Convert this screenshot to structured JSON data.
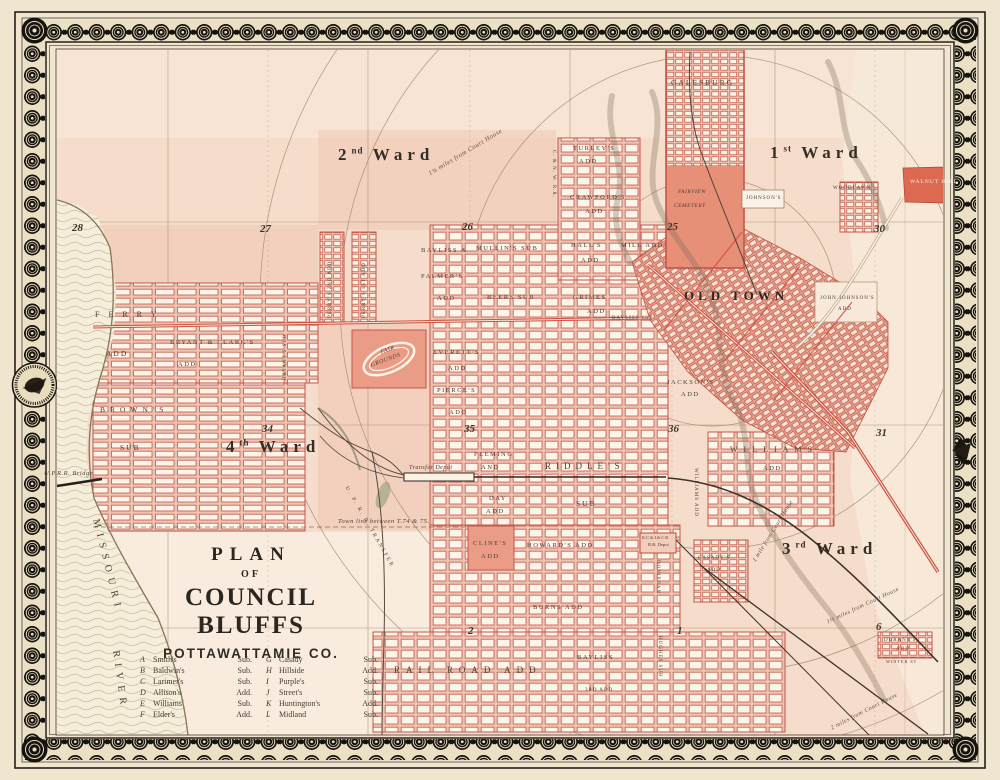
{
  "sheet": {
    "map_name": "Plan of Council Bluffs, Pottawattamie Co."
  },
  "title_block": {
    "plan": "PLAN",
    "of": "OF",
    "city": "COUNCIL BLUFFS",
    "county": "POTTAWATTAMIE CO."
  },
  "wards": {
    "first": {
      "num": "1",
      "sup": "st",
      "word": "Ward"
    },
    "second": {
      "num": "2",
      "sup": "nd",
      "word": "Ward"
    },
    "third": {
      "num": "3",
      "sup": "rd",
      "word": "Ward"
    },
    "fourth": {
      "num": "4",
      "sup": "th",
      "word": "Ward"
    }
  },
  "sections": {
    "s28": "28",
    "s27": "27",
    "s26": "26",
    "s25": "25",
    "s30": "30",
    "s34": "34",
    "s35": "35",
    "s36": "36",
    "s31": "31",
    "s2": "2",
    "s1": "1",
    "s6": "6"
  },
  "river": {
    "name_top": "MISSOURI",
    "name_bottom": "RIVER"
  },
  "legend": {
    "left": [
      {
        "key": "A",
        "name": "Smith's",
        "type": "Sub."
      },
      {
        "key": "B",
        "name": "Baldwin's",
        "type": "Sub."
      },
      {
        "key": "C",
        "name": "Larimer's",
        "type": "Sub."
      },
      {
        "key": "D",
        "name": "Allison's",
        "type": "Add."
      },
      {
        "key": "E",
        "name": "Williams",
        "type": "Sub."
      },
      {
        "key": "F",
        "name": "Elder's",
        "type": "Add."
      }
    ],
    "right": [
      {
        "key": "G",
        "name": "Casady",
        "type": "Sub."
      },
      {
        "key": "H",
        "name": "Hillside",
        "type": "Add."
      },
      {
        "key": "I",
        "name": "Purple's",
        "type": "Sub."
      },
      {
        "key": "J",
        "name": "Street's",
        "type": "Sub."
      },
      {
        "key": "K",
        "name": "Huntington's",
        "type": "Add."
      },
      {
        "key": "L",
        "name": "Midland",
        "type": "Sub."
      }
    ]
  },
  "labels": {
    "ferry": "FERRY",
    "ferry_add": "ADD",
    "browns": "BROWN'S",
    "browns_sub": "SUB",
    "bryant_clark": "BRYANT & CLARK'S",
    "bryant_clark_add": "ADD",
    "bryants_sub": "BRYANT'S SUB",
    "perrys2": "PERRY'S 2ND ADD",
    "perrys1": "PERRY'S 1ST ADD",
    "fair": "FAIR",
    "grounds": "GROUNDS",
    "everetts": "EVERETT'S",
    "everetts_add": "ADD",
    "pierces": "PIERCE'S",
    "pierces_add": "ADD",
    "bayliss_amp": "BAYLISS &",
    "palmers": "PALMER'S",
    "palmers_add": "ADD",
    "mullins": "MULLIN'S SUB",
    "halls": "HALL'S",
    "halls_add": "ADD",
    "beers": "BEERS SUB",
    "grimes": "GRIMES",
    "grimes_add": "ADD",
    "mill_add": "MILL ADD",
    "turleys": "TURLEY'S",
    "turleys_add": "ADD",
    "crawfords": "CRAWFORD'S",
    "crawfords_add": "ADD",
    "galesburg": "GALESBURG",
    "fairview": "FAIRVIEW",
    "cemetery": "CEMETERY",
    "johnsons": "JOHNSON'S",
    "woodlawn": "WOODLAWN",
    "walnut_hill": "WALNUT HILL",
    "john_johnsons": "JOHN JOHNSON'S",
    "john_johnsons_add": "ADD",
    "bayliss_1st": "BAYLISS 1ST",
    "jacksons": "JACKSON'S",
    "jacksons_add": "ADD",
    "old_town": "OLD TOWN",
    "williams": "WILLIAMS",
    "williams_add_word": "ADD",
    "casadys": "CASADY'S",
    "casadys_add": "ADD",
    "fleming": "FLEMING",
    "fleming_and": "AND",
    "riddles": "RIDDLE'S",
    "riddles_sub": "SUB",
    "day": "DAY",
    "day_add": "ADD",
    "clines": "CLINE'S",
    "clines_add": "ADD",
    "howards_add": "HOWARD'S ADD",
    "burns_add": "BURNS ADD",
    "railroad_add": "RAIL ROAD ADD",
    "bayliss_b": "BAYLISS",
    "bayliss_3rd": "3RD ADD",
    "hughes": "HUGHES SUB",
    "doniphan": "DONIPHAN",
    "williams_vert": "WILLIAMS ADD",
    "durants": "DURANT'S",
    "durants_add": "ADD",
    "winter_st": "WINTER ST"
  },
  "notes": {
    "upr_bridge": "U.P.R.R. Bridge",
    "transfer_depot": "Transfer Depot",
    "town_line": "Town line between T.74 & 75.",
    "uprr_transfer": "U. P. R. R. TRANSFER",
    "cnw": "C. & N. W. R.R.",
    "rr_depot_1": "K.C.St.J.& C.B.",
    "rr_depot_2": "R.R. Depot"
  },
  "distances": {
    "d175": "1¾ miles from Court House",
    "d1": "1 mile from Court House",
    "d15": "1½ miles from Court House",
    "d2": "2 miles from Court House"
  }
}
